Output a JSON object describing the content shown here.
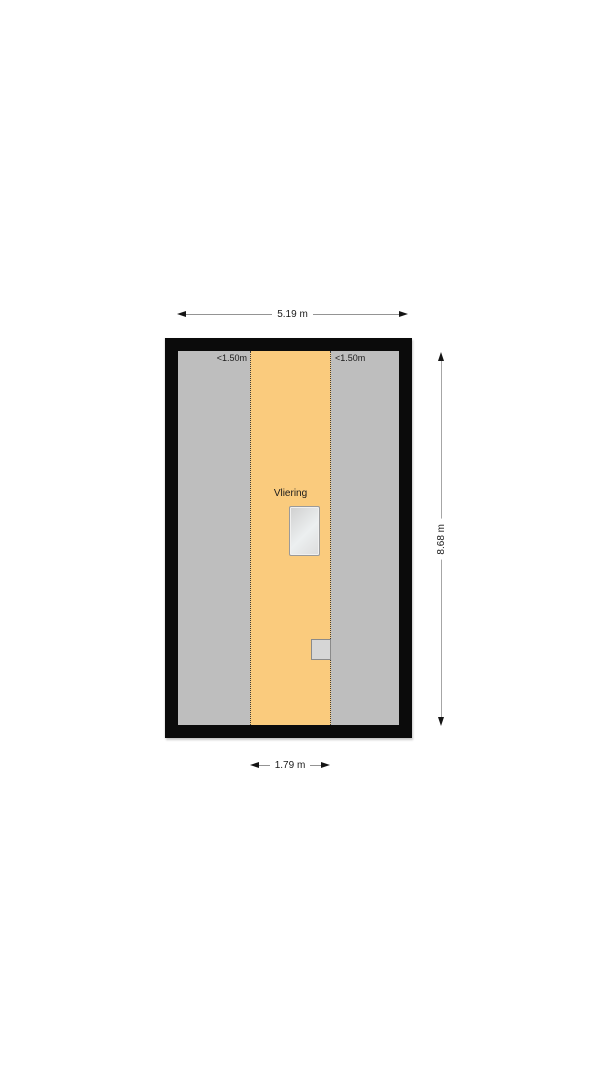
{
  "plan": {
    "room_label": "Vliering",
    "dimensions": {
      "width": "5.19 m",
      "height": "8.68 m",
      "strip_width": "1.79 m"
    },
    "zone_labels": {
      "left": "<1.50m",
      "right": "<1.50m"
    },
    "colors": {
      "wall": "#0b0b0b",
      "low_headroom_floor": "#bebebe",
      "main_floor": "#facb7d",
      "partition_dotted_line": "#3c3c3c",
      "roof_window_fill": "#e3e6e7",
      "roof_window_border": "#9a9a9a",
      "fixture_fill": "#d6d6d6",
      "dimension_line": "#949494",
      "arrow": "#141414",
      "text": "#1a1a1a",
      "background": "#ffffff"
    }
  }
}
